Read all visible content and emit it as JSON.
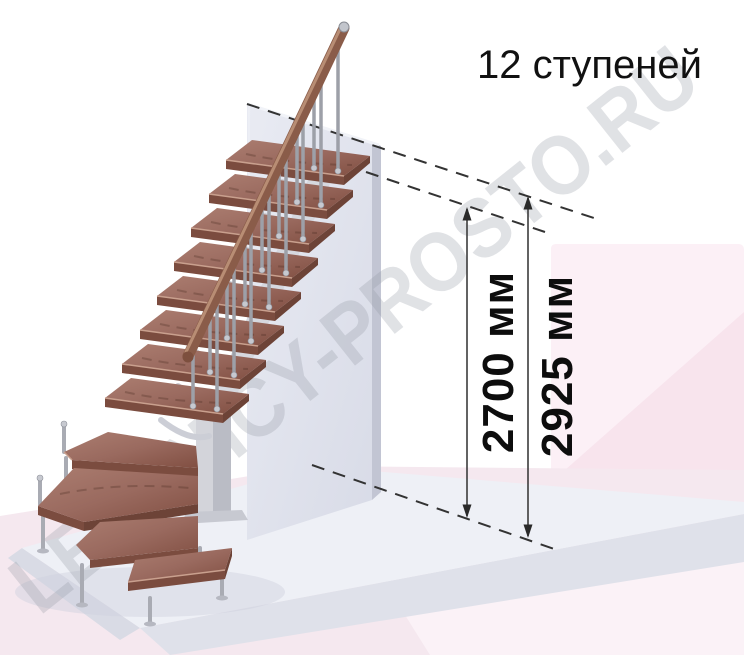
{
  "title": "12 ступеней",
  "watermark": "LESTNICY-PROSTO.RU",
  "dimensions": {
    "inner": {
      "value": "2700",
      "unit": "мм",
      "label": "2700 мм"
    },
    "outer": {
      "value": "2925",
      "unit": "мм",
      "label": "2925 мм"
    }
  },
  "illustration": {
    "steps_shown": 12,
    "colors": {
      "wood_light": "#ab7d70",
      "wood_mid": "#9a6a5f",
      "wood_dark": "#814f42",
      "wood_front": "#7b4c3f",
      "handrail": "#8a5c49",
      "handrail_highlight": "#c49a7f",
      "metal": "#9da0a8",
      "wall": "#e0e2ec",
      "wall_edge": "#c2c5d3",
      "floor_slab": "#eef0f6",
      "floor_edge": "#dfe1ea",
      "pink_bottom": "#f5e8ef",
      "pink_panel": "#fcf0f6",
      "pink_accent": "#f7e2eb",
      "pink_light": "#fbf2f7",
      "dashed_line": "#333333",
      "dimension_line": "#3c3c3c",
      "watermark_gray": "#9196a1",
      "text": "#111111"
    }
  }
}
